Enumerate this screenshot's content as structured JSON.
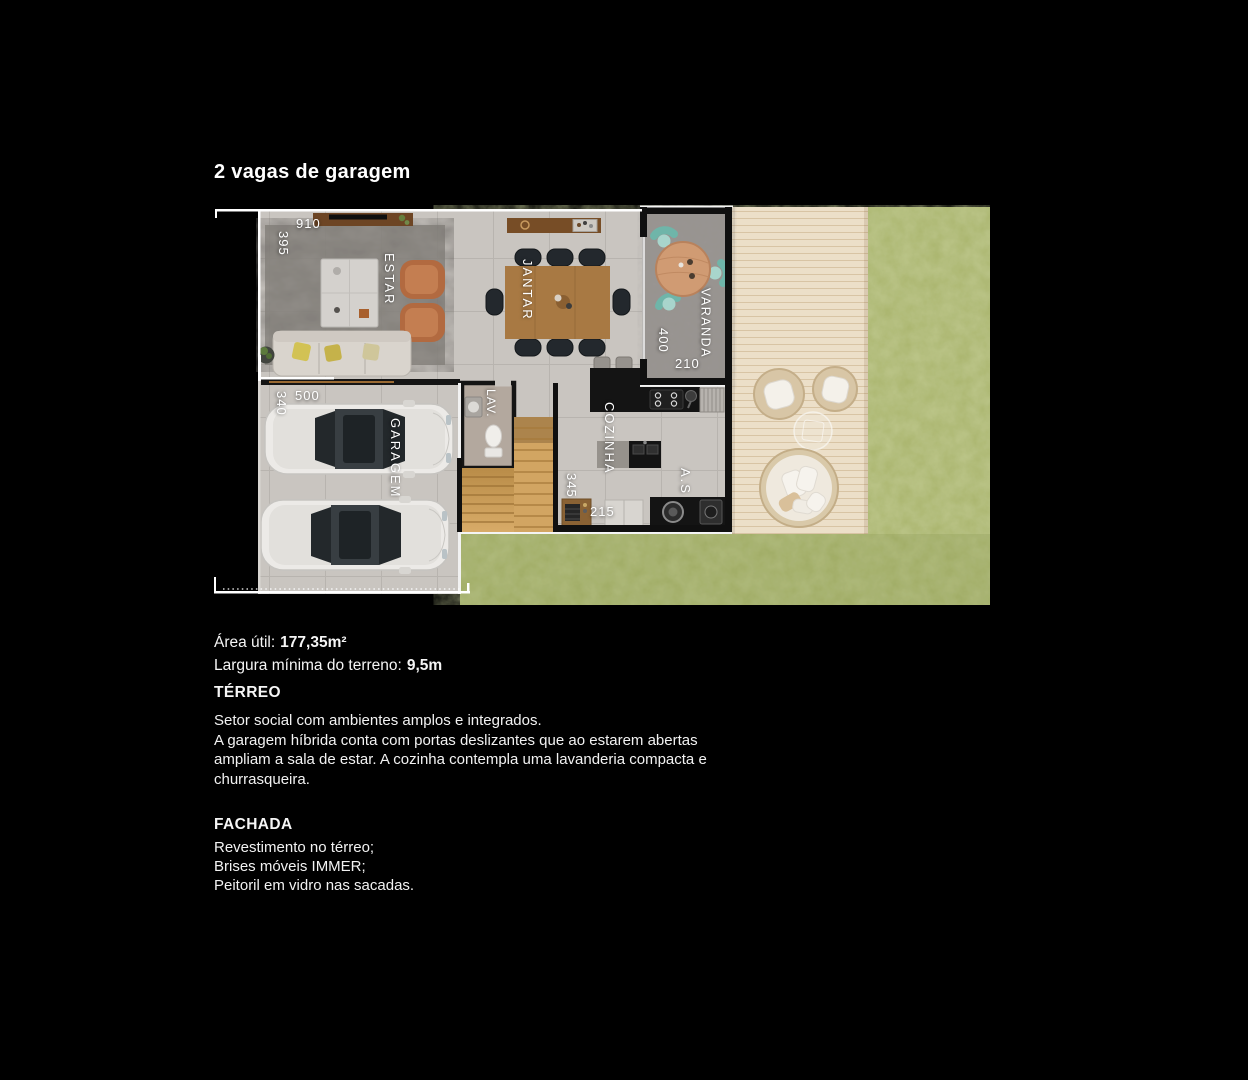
{
  "title": "2 vagas de garagem",
  "plan": {
    "rooms": {
      "estar": "ESTAR",
      "jantar": "JANTAR",
      "varanda": "VARANDA",
      "garagem": "GARAGEM",
      "lav": "LAV.",
      "cozinha": "COZINHA",
      "servico": "A.S"
    },
    "dims": {
      "d910": "910",
      "d395": "395",
      "d500": "500",
      "d340": "340",
      "d400": "400",
      "d210": "210",
      "d345": "345",
      "d215": "215"
    }
  },
  "details": {
    "area_label": "Área útil:",
    "area_value": "177,35m²",
    "terrain_label": "Largura mínima do terreno:",
    "terrain_value": "9,5m"
  },
  "terreo": {
    "heading": "TÉRREO",
    "paragraphs": [
      "Setor social com ambientes amplos e integrados.",
      "A garagem híbrida conta com portas deslizantes que ao estarem abertas ampliam a sala de estar. A cozinha contempla uma lavanderia compacta e churrasqueira."
    ]
  },
  "fachada": {
    "heading": "FACHADA",
    "items": [
      "Revestimento no térreo;",
      "Brises móveis IMMER;",
      "Peitoril em vidro nas sacadas."
    ]
  },
  "colors": {
    "background": "#000000",
    "text": "#f5f5f5",
    "grass": "#a9b46c",
    "deck": "#ecdfc8",
    "floor_tile": "#c9c5c0",
    "wall_dark": "#101010",
    "wall_light": "#ffffff",
    "wood": "#a87943",
    "teal_chair": "#6fb5a9"
  }
}
